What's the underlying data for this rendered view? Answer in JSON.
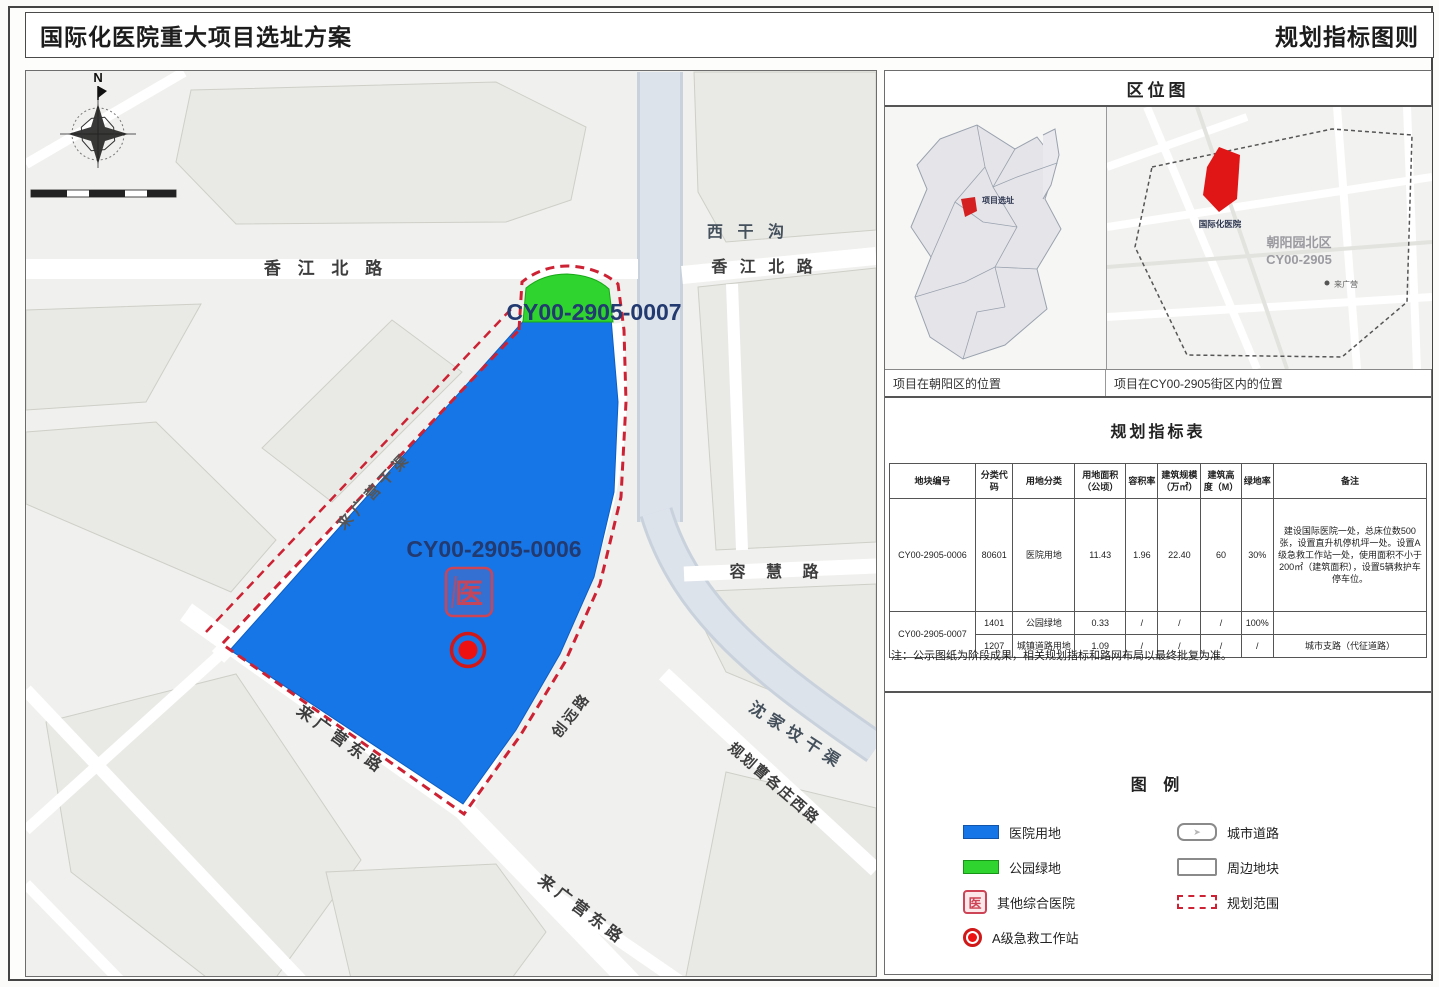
{
  "header": {
    "title_left": "国际化医院重大项目选址方案",
    "title_right": "规划指标图则"
  },
  "map": {
    "north_label": "N",
    "parcels": {
      "hospital_code": "CY00-2905-0006",
      "park_code": "CY00-2905-0007",
      "hospital_color": "#1676e8",
      "park_color": "#2fd42f",
      "boundary_color": "#cc2233",
      "stamp_glyph": "医"
    },
    "roads": {
      "xiangjiang_left": "香 江 北 路",
      "xigangou": "西 干 沟",
      "xiangjiang_right": "香 江 北 路",
      "ronghui": "容 慧 路",
      "shenjiafen_canal": "沈家坟干渠",
      "caogezhuang": "规划曹各庄西路",
      "laiguangying_sw": "来广营东路",
      "laiguangying_s": "来广营东路",
      "chuangyuan": "创远路",
      "nw_canal": "来广营干渠"
    }
  },
  "sidebar": {
    "location": {
      "title": "区位图",
      "caption_left": "项目在朝阳区的位置",
      "caption_right": "项目在CY00-2905街区内的位置",
      "district_marker_label": "项目选址",
      "zone_name": "朝阳园北区",
      "zone_code": "CY00-2905",
      "site_label": "国际化医院",
      "station_label": "来广营"
    },
    "table": {
      "title": "规划指标表",
      "headers": [
        "地块编号",
        "分类代码",
        "用地分类",
        "用地面积（公顷）",
        "容积率",
        "建筑规模（万㎡）",
        "建筑高度（M）",
        "绿地率",
        "备注"
      ],
      "rows": [
        [
          "CY00-2905-0006",
          "80601",
          "医院用地",
          "11.43",
          "1.96",
          "22.40",
          "60",
          "30%",
          "建设国际医院一处，总床位数500张，设置直升机停机坪一处。设置A级急救工作站一处，使用面积不小于200㎡（建筑面积），设置5辆救护车停车位。"
        ],
        [
          "CY00-2905-0007",
          "1401",
          "公园绿地",
          "0.33",
          "/",
          "/",
          "/",
          "100%",
          ""
        ],
        [
          "",
          "1207",
          "城镇道路用地",
          "1.09",
          "/",
          "/",
          "/",
          "/",
          "城市支路（代征道路）"
        ]
      ],
      "note": "注：公示图纸为阶段成果，相关规划指标和路网布局以最终批复为准。"
    },
    "legend": {
      "title": "图 例",
      "left": [
        {
          "label": "医院用地"
        },
        {
          "label": "公园绿地"
        },
        {
          "label": "其他综合医院"
        },
        {
          "label": "A级急救工作站"
        }
      ],
      "right": [
        {
          "label": "城市道路"
        },
        {
          "label": "周边地块"
        },
        {
          "label": "规划范围"
        }
      ],
      "road_arrow": "➤",
      "stamp_glyph": "医"
    }
  }
}
